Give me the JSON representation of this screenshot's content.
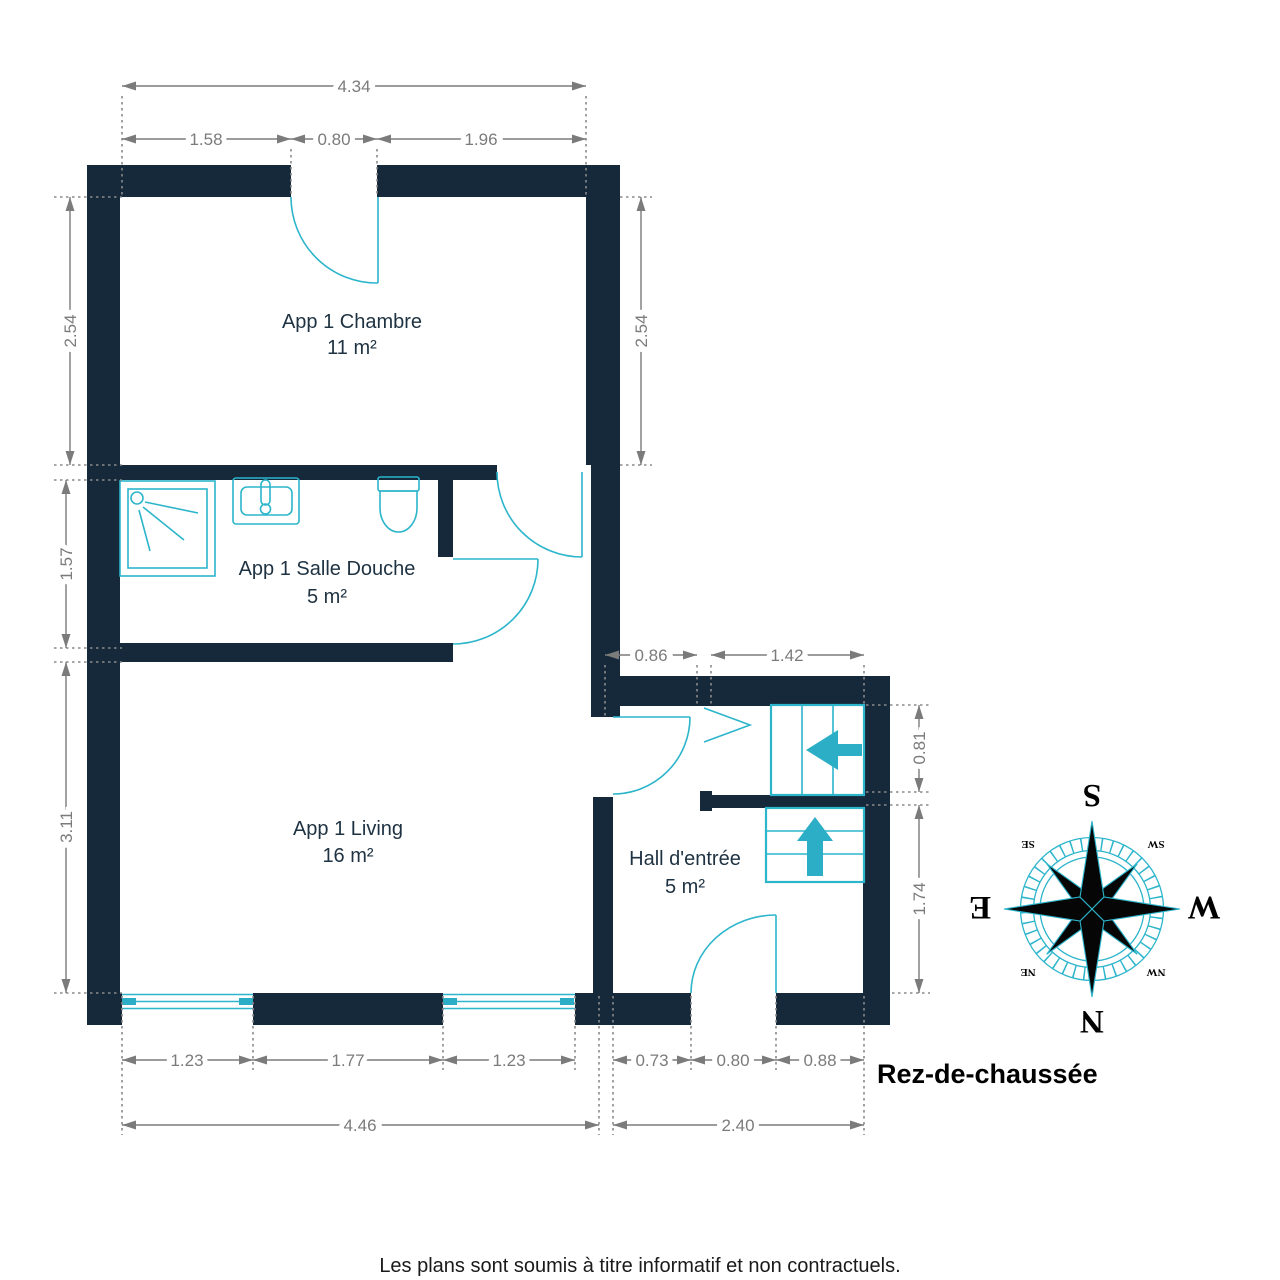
{
  "title": {
    "floor_label": "Rez-de-chaussée",
    "disclaimer": "Les plans sont soumis à titre informatif et non contractuels."
  },
  "rooms": [
    {
      "name": "App 1 Chambre",
      "area": "11 m²"
    },
    {
      "name": "App 1 Salle Douche",
      "area": "5 m²"
    },
    {
      "name": "App 1 Living",
      "area": "16 m²"
    },
    {
      "name": "Hall d'entrée",
      "area": "5 m²"
    }
  ],
  "dims": {
    "top_total": "4.34",
    "top_seg1": "1.58",
    "top_door": "0.80",
    "top_seg2": "1.96",
    "chambre_left": "2.54",
    "chambre_right": "2.54",
    "sdb_left": "1.57",
    "living_left": "3.11",
    "hall_top_seg1": "0.86",
    "hall_top_seg2": "1.42",
    "stair_upper": "0.81",
    "hall_right": "1.74",
    "bottom_win1": "1.23",
    "bottom_mid": "1.77",
    "bottom_win2": "1.23",
    "hall_b1": "0.73",
    "hall_bdoor": "0.80",
    "hall_b2": "0.88",
    "living_total": "4.46",
    "hall_total": "2.40"
  },
  "compass": {
    "n": "N",
    "e": "E",
    "s": "S",
    "w": "W",
    "ne": "NE",
    "se": "SE",
    "sw": "SW",
    "nw": "NW"
  },
  "colors": {
    "wall": "#16293A",
    "fixture": "#2CB5CB",
    "dimension": "#7B7B7B",
    "label": "#1E3242"
  }
}
